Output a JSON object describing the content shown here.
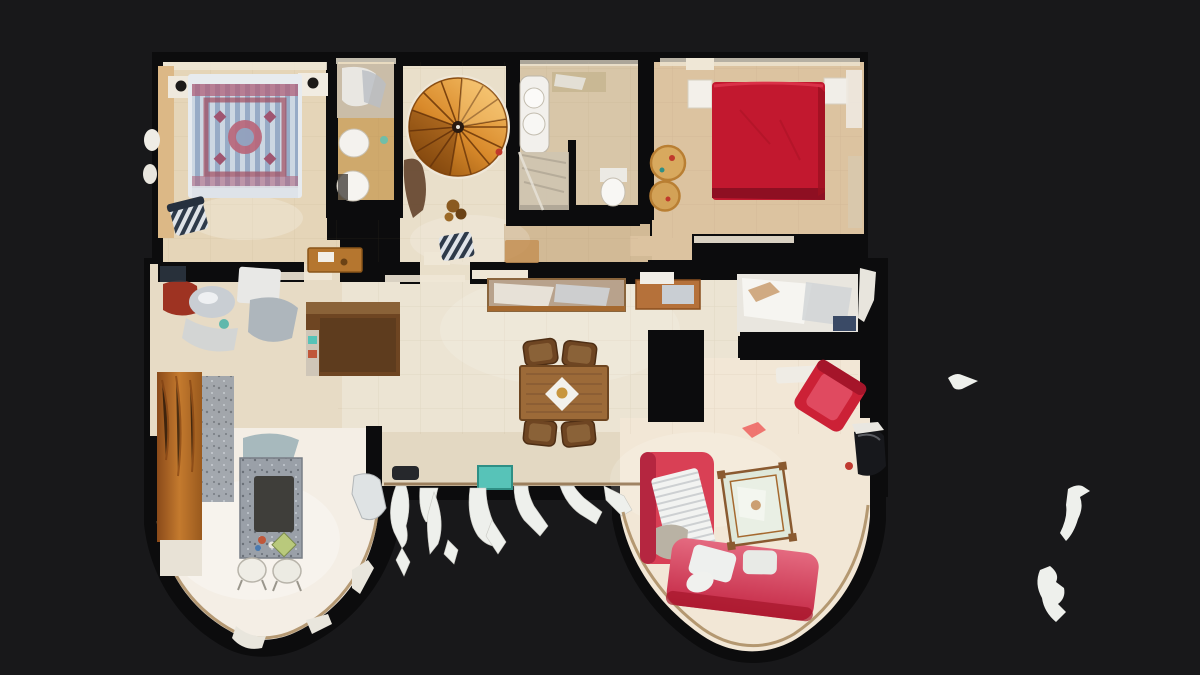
{
  "viewer": {
    "colors": {
      "background": "#18181a",
      "wall_void": "#0c0c0d",
      "wall_top": "#efe7d6",
      "floor_bedroom1": "#e5d5b8",
      "floor_bath1": "#cfa96c",
      "floor_stair": "#e9dfca",
      "floor_bath2": "#d8c6a8",
      "floor_corridor": "#d2ba96",
      "floor_bedroom2": "#dcc3a0",
      "floor_hall": "#ece4d3",
      "floor_left_room": "#e7dbc5",
      "floor_turret_left": "#f4eee5",
      "floor_turret_right": "#f2e7d6",
      "floor_balcony": "#e3d8c2",
      "bed1_base": "#e7ebef",
      "bed1_stripe_blue": "#97abc6",
      "bed1_motif_red": "#b0607a",
      "bed2_red": "#c2182f",
      "bed2_red_dark": "#8e0f22",
      "stair_wood": "#d98a2b",
      "stair_wood_dark": "#8a4d12",
      "sofa_red": "#d94055",
      "sofa_pink": "#e87f93",
      "armchair_red": "#cc2136",
      "glass_green": "#dfe8da",
      "table_wood": "#9c6a38",
      "chair_wood": "#6e4522",
      "granite_gray": "#9aa0a8",
      "granite_dark": "#3f3e3a",
      "cabinet_amber": "#b36a22",
      "steel": "#c9ced3",
      "copper": "#b5713a",
      "white_object": "#f6f4ef",
      "teal_accent": "#57c3b8",
      "pouf_tan": "#d8a95e",
      "dark_object": "#17181c",
      "artifact_white": "#eef0ec",
      "turret_border": "#a98a5f"
    }
  }
}
